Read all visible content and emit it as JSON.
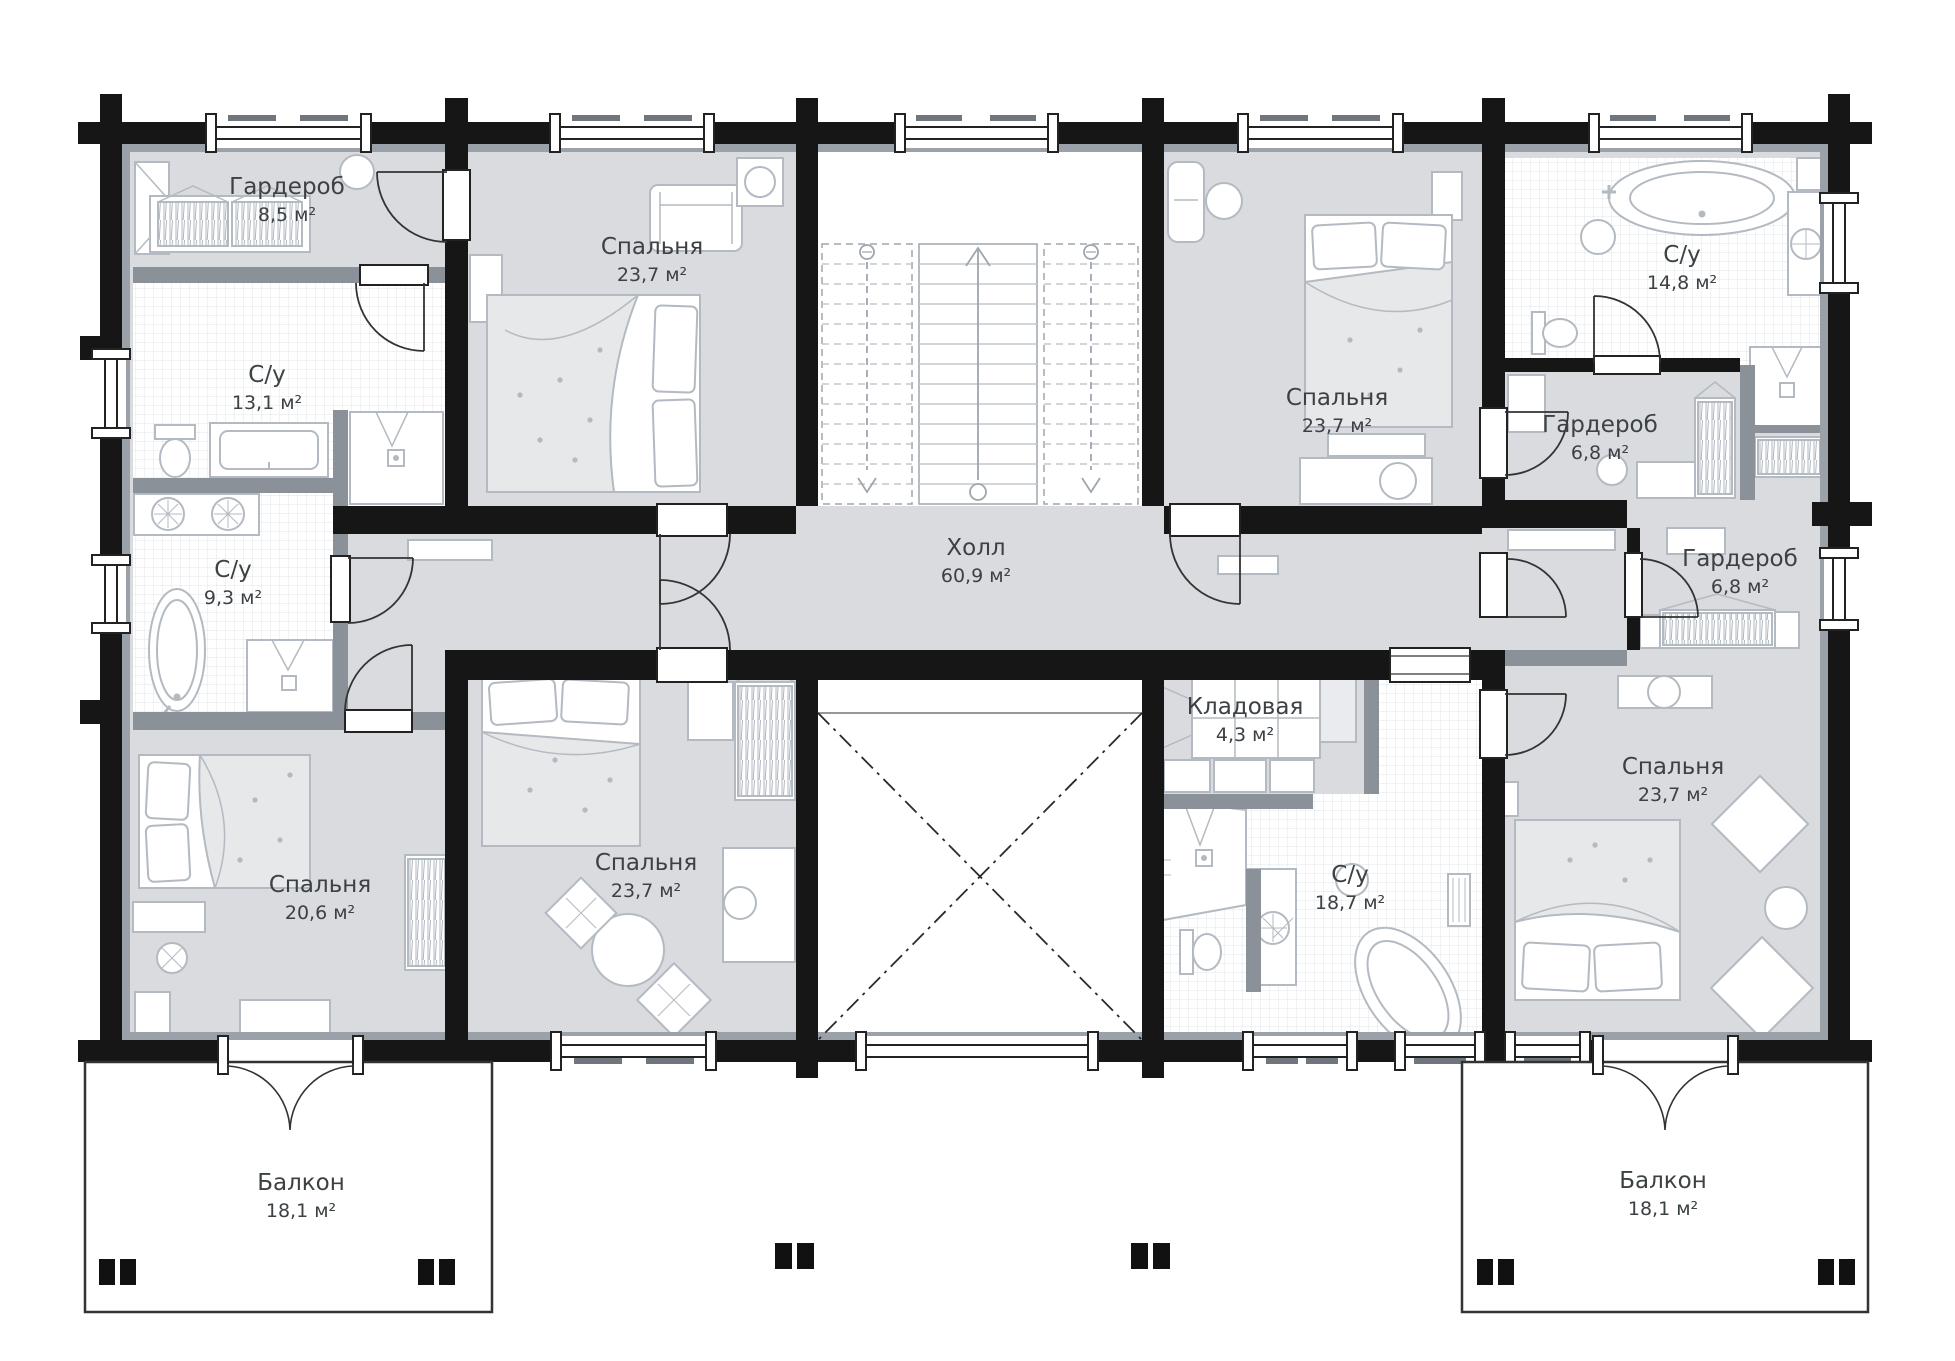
{
  "palette": {
    "room_fill": "#d9dbde",
    "wall": "#161616",
    "partition": "#8a9199",
    "tile_line": "#e1e4e8",
    "furniture_line": "#b3bac1",
    "text": "#3c4144",
    "background": "#ffffff"
  },
  "units": "м²",
  "rooms": {
    "garderob_tl": {
      "name": "Гардероб",
      "area": "8,5 м²"
    },
    "su_13": {
      "name": "С/у",
      "area": "13,1 м²"
    },
    "bedroom_tl": {
      "name": "Спальня",
      "area": "23,7 м²"
    },
    "hall": {
      "name": "Холл",
      "area": "60,9 м²"
    },
    "bedroom_tr": {
      "name": "Спальня",
      "area": "23,7 м²"
    },
    "su_14": {
      "name": "С/у",
      "area": "14,8 м²"
    },
    "garderob_r1": {
      "name": "Гардероб",
      "area": "6,8 м²"
    },
    "garderob_r2": {
      "name": "Гардероб",
      "area": "6,8 м²"
    },
    "su_9": {
      "name": "С/у",
      "area": "9,3 м²"
    },
    "bedroom_206": {
      "name": "Спальня",
      "area": "20,6 м²"
    },
    "bedroom_bl": {
      "name": "Спальня",
      "area": "23,7 м²"
    },
    "kladovaya": {
      "name": "Кладовая",
      "area": "4,3 м²"
    },
    "su_18": {
      "name": "С/у",
      "area": "18,7 м²"
    },
    "bedroom_br": {
      "name": "Спальня",
      "area": "23,7 м²"
    },
    "balcony_l": {
      "name": "Балкон",
      "area": "18,1 м²"
    },
    "balcony_r": {
      "name": "Балкон",
      "area": "18,1 м²"
    }
  }
}
